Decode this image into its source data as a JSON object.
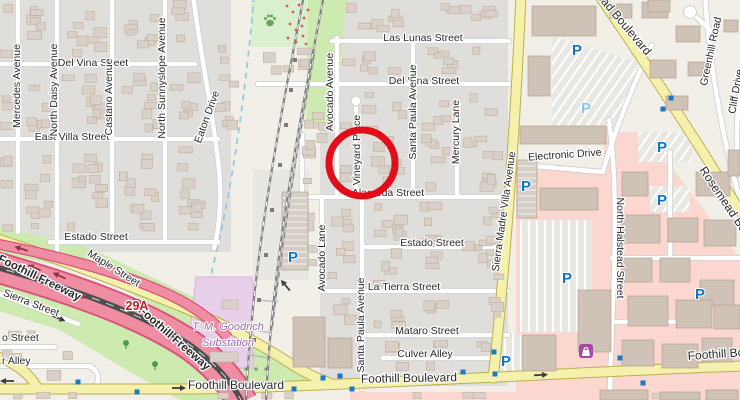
{
  "map": {
    "kind": "openstreetmap-style street map",
    "annotation": {
      "shape": "circle",
      "cx": 362,
      "cy": 163,
      "r": 33,
      "stroke_width": 7,
      "color": "#e20d18",
      "purpose": "highlights Vineyard Place"
    }
  },
  "colors": {
    "bg": "#f2efe9",
    "residential": "#e0dedb",
    "retail": "#fbd7d0",
    "park": "#d9f0cf",
    "grass": "#cdebb0",
    "water": "#8fc8de",
    "substation": "#e8d0ea",
    "substation-border": "#d8b2da",
    "substation-text": "#9f6ab2",
    "road-white": "#ffffff",
    "road-casing": "#c9c9c9",
    "secondary": "#f5f1ad",
    "secondary-casing": "#bab04e",
    "motorway": "#ef8ea3",
    "motorway-casing": "#d9537a",
    "median": "#4f4f4f",
    "building": "#d9d0c9",
    "building-stroke": "#bfae9b",
    "rail": "#818181",
    "parking-lot": "#e9e7e2",
    "label": "#2b2b2b",
    "parking-blue": "#0f72c7",
    "parking-light": "#8fc3ea",
    "signal": "#1a78c8",
    "exit-red": "#c01c28",
    "tree": "#4f9a4f",
    "arrow": "#3d3d3d",
    "fwy-arrow": "#8d3048",
    "shop-purple": "#a349a3",
    "flower": "#e2574d",
    "paw": "#69a55e"
  },
  "labels": [
    {
      "name": "street-label-las-lunas",
      "text": "Las Lunas Street",
      "x": 423,
      "y": 41,
      "r": 0,
      "kind": "street"
    },
    {
      "name": "street-label-del-vina-center",
      "text": "Del Vina Street",
      "x": 424,
      "y": 84,
      "r": 0,
      "kind": "street"
    },
    {
      "name": "street-label-del-vina-left",
      "text": "Del Vina Street",
      "x": 93,
      "y": 66,
      "r": 0,
      "kind": "street"
    },
    {
      "name": "street-label-east-villa",
      "text": "East Villa Street",
      "x": 72,
      "y": 140,
      "r": 0,
      "kind": "street"
    },
    {
      "name": "street-label-estado-left",
      "text": "Estado Street",
      "x": 96,
      "y": 240,
      "r": 0,
      "kind": "street"
    },
    {
      "name": "street-label-estado-center",
      "text": "Estado Street",
      "x": 432,
      "y": 246,
      "r": 0,
      "kind": "street"
    },
    {
      "name": "street-label-alameda",
      "text": "Alameda Street",
      "x": 388,
      "y": 196,
      "r": 0,
      "kind": "street"
    },
    {
      "name": "street-label-la-tierra",
      "text": "La Tierra Street",
      "x": 404,
      "y": 290,
      "r": 0,
      "kind": "street"
    },
    {
      "name": "street-label-mataro",
      "text": "Mataro Street",
      "x": 427,
      "y": 334,
      "r": 0,
      "kind": "street"
    },
    {
      "name": "street-label-culver-alley",
      "text": "Culver Alley",
      "x": 425,
      "y": 357,
      "r": 0,
      "kind": "street"
    },
    {
      "name": "street-label-electronic-drive",
      "text": "Electronic Drive",
      "x": 565,
      "y": 158,
      "r": -4,
      "kind": "street"
    },
    {
      "name": "street-label-foothill-blvd-west",
      "text": "Foothill Boulevard",
      "x": 236,
      "y": 389,
      "r": 0,
      "kind": "main"
    },
    {
      "name": "street-label-foothill-blvd-center",
      "text": "Foothill Boulevard",
      "x": 409,
      "y": 382,
      "r": -1,
      "kind": "main"
    },
    {
      "name": "street-label-foothill-blvd-east",
      "text": "Foothill Boulevard",
      "x": 688,
      "y": 360,
      "r": -4,
      "kind": "main",
      "anchor": "start"
    },
    {
      "name": "street-label-o-street-clipped",
      "text": "o Street",
      "x": 2,
      "y": 341,
      "r": 0,
      "kind": "street",
      "anchor": "start"
    },
    {
      "name": "street-label-r-alley-clipped",
      "text": "r Alley",
      "x": 2,
      "y": 364,
      "r": 0,
      "kind": "street",
      "anchor": "start"
    },
    {
      "name": "street-label-mercedes",
      "text": "Mercedes Avenue",
      "x": 20,
      "y": 86,
      "r": -90,
      "kind": "street"
    },
    {
      "name": "street-label-north-daisy",
      "text": "North Daisy Avenue",
      "x": 57,
      "y": 90,
      "r": -90,
      "kind": "street"
    },
    {
      "name": "street-label-castano",
      "text": "Castano Avenue",
      "x": 112,
      "y": 97,
      "r": -90,
      "kind": "street"
    },
    {
      "name": "street-label-north-sunnyslope",
      "text": "North Sunnyslope Avenue",
      "x": 165,
      "y": 78,
      "r": -90,
      "kind": "street"
    },
    {
      "name": "street-label-avocado-avenue",
      "text": "Avocado Avenue",
      "x": 333,
      "y": 92,
      "r": -90,
      "kind": "street"
    },
    {
      "name": "street-label-vineyard-place",
      "text": "Vineyard Place",
      "x": 360,
      "y": 150,
      "r": -90,
      "kind": "street"
    },
    {
      "name": "street-label-santa-paula-north",
      "text": "Santa Paula Avenue",
      "x": 416,
      "y": 112,
      "r": -90,
      "kind": "street"
    },
    {
      "name": "street-label-mercury-lane",
      "text": "Mercury Lane",
      "x": 459,
      "y": 132,
      "r": -90,
      "kind": "street"
    },
    {
      "name": "street-label-avocado-lane",
      "text": "Avocado Lane",
      "x": 325,
      "y": 258,
      "r": -90,
      "kind": "street"
    },
    {
      "name": "street-label-santa-paula-south",
      "text": "Santa Paula Avenue",
      "x": 364,
      "y": 325,
      "r": -90,
      "kind": "street"
    },
    {
      "name": "street-label-north-halstead",
      "text": "North Halstead Street",
      "x": 617,
      "y": 248,
      "r": 90,
      "kind": "street"
    },
    {
      "name": "street-label-sierra-madre-villa",
      "text": "Sierra Madre Villa Avenue",
      "x": 507,
      "y": 212,
      "r": -82,
      "kind": "street"
    },
    {
      "name": "street-label-eaton-drive",
      "text": "Eaton Drive",
      "x": 210,
      "y": 118,
      "r": -70,
      "kind": "street"
    },
    {
      "name": "street-label-maple",
      "text": "Maple Street",
      "x": 112,
      "y": 271,
      "r": 32,
      "kind": "street"
    },
    {
      "name": "street-label-sierra",
      "text": "Sierra Street",
      "x": 30,
      "y": 306,
      "r": 21,
      "kind": "street"
    },
    {
      "name": "street-label-foothill-freeway-1",
      "text": "Foothill Freeway",
      "x": 38,
      "y": 281,
      "r": 26,
      "kind": "freeway"
    },
    {
      "name": "street-label-foothill-freeway-2",
      "text": "Foothill Freeway",
      "x": 172,
      "y": 341,
      "r": 41,
      "kind": "freeway"
    },
    {
      "name": "street-label-rosemead-north",
      "text": "Rosemead Boulevard",
      "x": 646,
      "y": 56,
      "r": 50,
      "kind": "main",
      "anchor": "end"
    },
    {
      "name": "street-label-rosemead-east",
      "text": "Rosemead Boulevard",
      "x": 699,
      "y": 170,
      "r": 56,
      "kind": "main",
      "anchor": "start"
    },
    {
      "name": "street-label-greenhill",
      "text": "Greenhill Road",
      "x": 714,
      "y": 52,
      "r": -78,
      "kind": "street"
    },
    {
      "name": "street-label-cliff-drive",
      "text": "Cliff Drive",
      "x": 739,
      "y": 92,
      "r": -80,
      "kind": "street"
    },
    {
      "name": "poi-label-substation-line1",
      "text": "T. M. Goodrich",
      "x": 228,
      "y": 330,
      "r": 0,
      "kind": "substation"
    },
    {
      "name": "poi-label-substation-line2",
      "text": "Substation",
      "x": 228,
      "y": 346,
      "r": 0,
      "kind": "substation"
    },
    {
      "name": "exit-ref-29a",
      "text": "29A",
      "x": 137,
      "y": 310,
      "r": 0,
      "kind": "exit"
    }
  ],
  "icons": {
    "parking_glyph": "P",
    "parking": [
      {
        "x": 293,
        "y": 262
      },
      {
        "x": 577,
        "y": 55
      },
      {
        "x": 586,
        "y": 113,
        "light": true
      },
      {
        "x": 526,
        "y": 191
      },
      {
        "x": 662,
        "y": 152
      },
      {
        "x": 662,
        "y": 205
      },
      {
        "x": 567,
        "y": 283
      },
      {
        "x": 700,
        "y": 299
      },
      {
        "x": 506,
        "y": 366
      }
    ],
    "signals": [
      {
        "x": 78,
        "y": 382
      },
      {
        "x": 137,
        "y": 392
      },
      {
        "x": 294,
        "y": 389
      },
      {
        "x": 323,
        "y": 378
      },
      {
        "x": 340,
        "y": 376
      },
      {
        "x": 352,
        "y": 389
      },
      {
        "x": 463,
        "y": 372
      },
      {
        "x": 494,
        "y": 352
      },
      {
        "x": 495,
        "y": 374
      },
      {
        "x": 620,
        "y": 358
      },
      {
        "x": 643,
        "y": 383
      },
      {
        "x": 671,
        "y": 98
      },
      {
        "x": 663,
        "y": 109
      }
    ],
    "trees": [
      {
        "x": 126,
        "y": 345
      },
      {
        "x": 155,
        "y": 366
      }
    ],
    "paw": {
      "x": 270,
      "y": 21
    },
    "shop": {
      "x": 579,
      "y": 344
    },
    "arrows": [
      {
        "x": 8,
        "y": 381,
        "a": 180,
        "c": "street"
      },
      {
        "x": 178,
        "y": 388,
        "a": 0,
        "c": "street"
      },
      {
        "x": 540,
        "y": 375,
        "a": -3,
        "c": "street"
      },
      {
        "x": 58,
        "y": 318,
        "a": 22,
        "c": "street"
      },
      {
        "x": 286,
        "y": 286,
        "a": 230,
        "c": "street"
      },
      {
        "x": 35,
        "y": 268,
        "a": 203,
        "c": "fwy"
      },
      {
        "x": 60,
        "y": 276,
        "a": 205,
        "c": "fwy"
      },
      {
        "x": 140,
        "y": 303,
        "a": 208,
        "c": "fwy"
      },
      {
        "x": 80,
        "y": 295,
        "a": 23,
        "c": "fwy"
      },
      {
        "x": 160,
        "y": 325,
        "a": 28,
        "c": "fwy"
      },
      {
        "x": 22,
        "y": 249,
        "a": 197,
        "c": "fwy"
      }
    ]
  }
}
